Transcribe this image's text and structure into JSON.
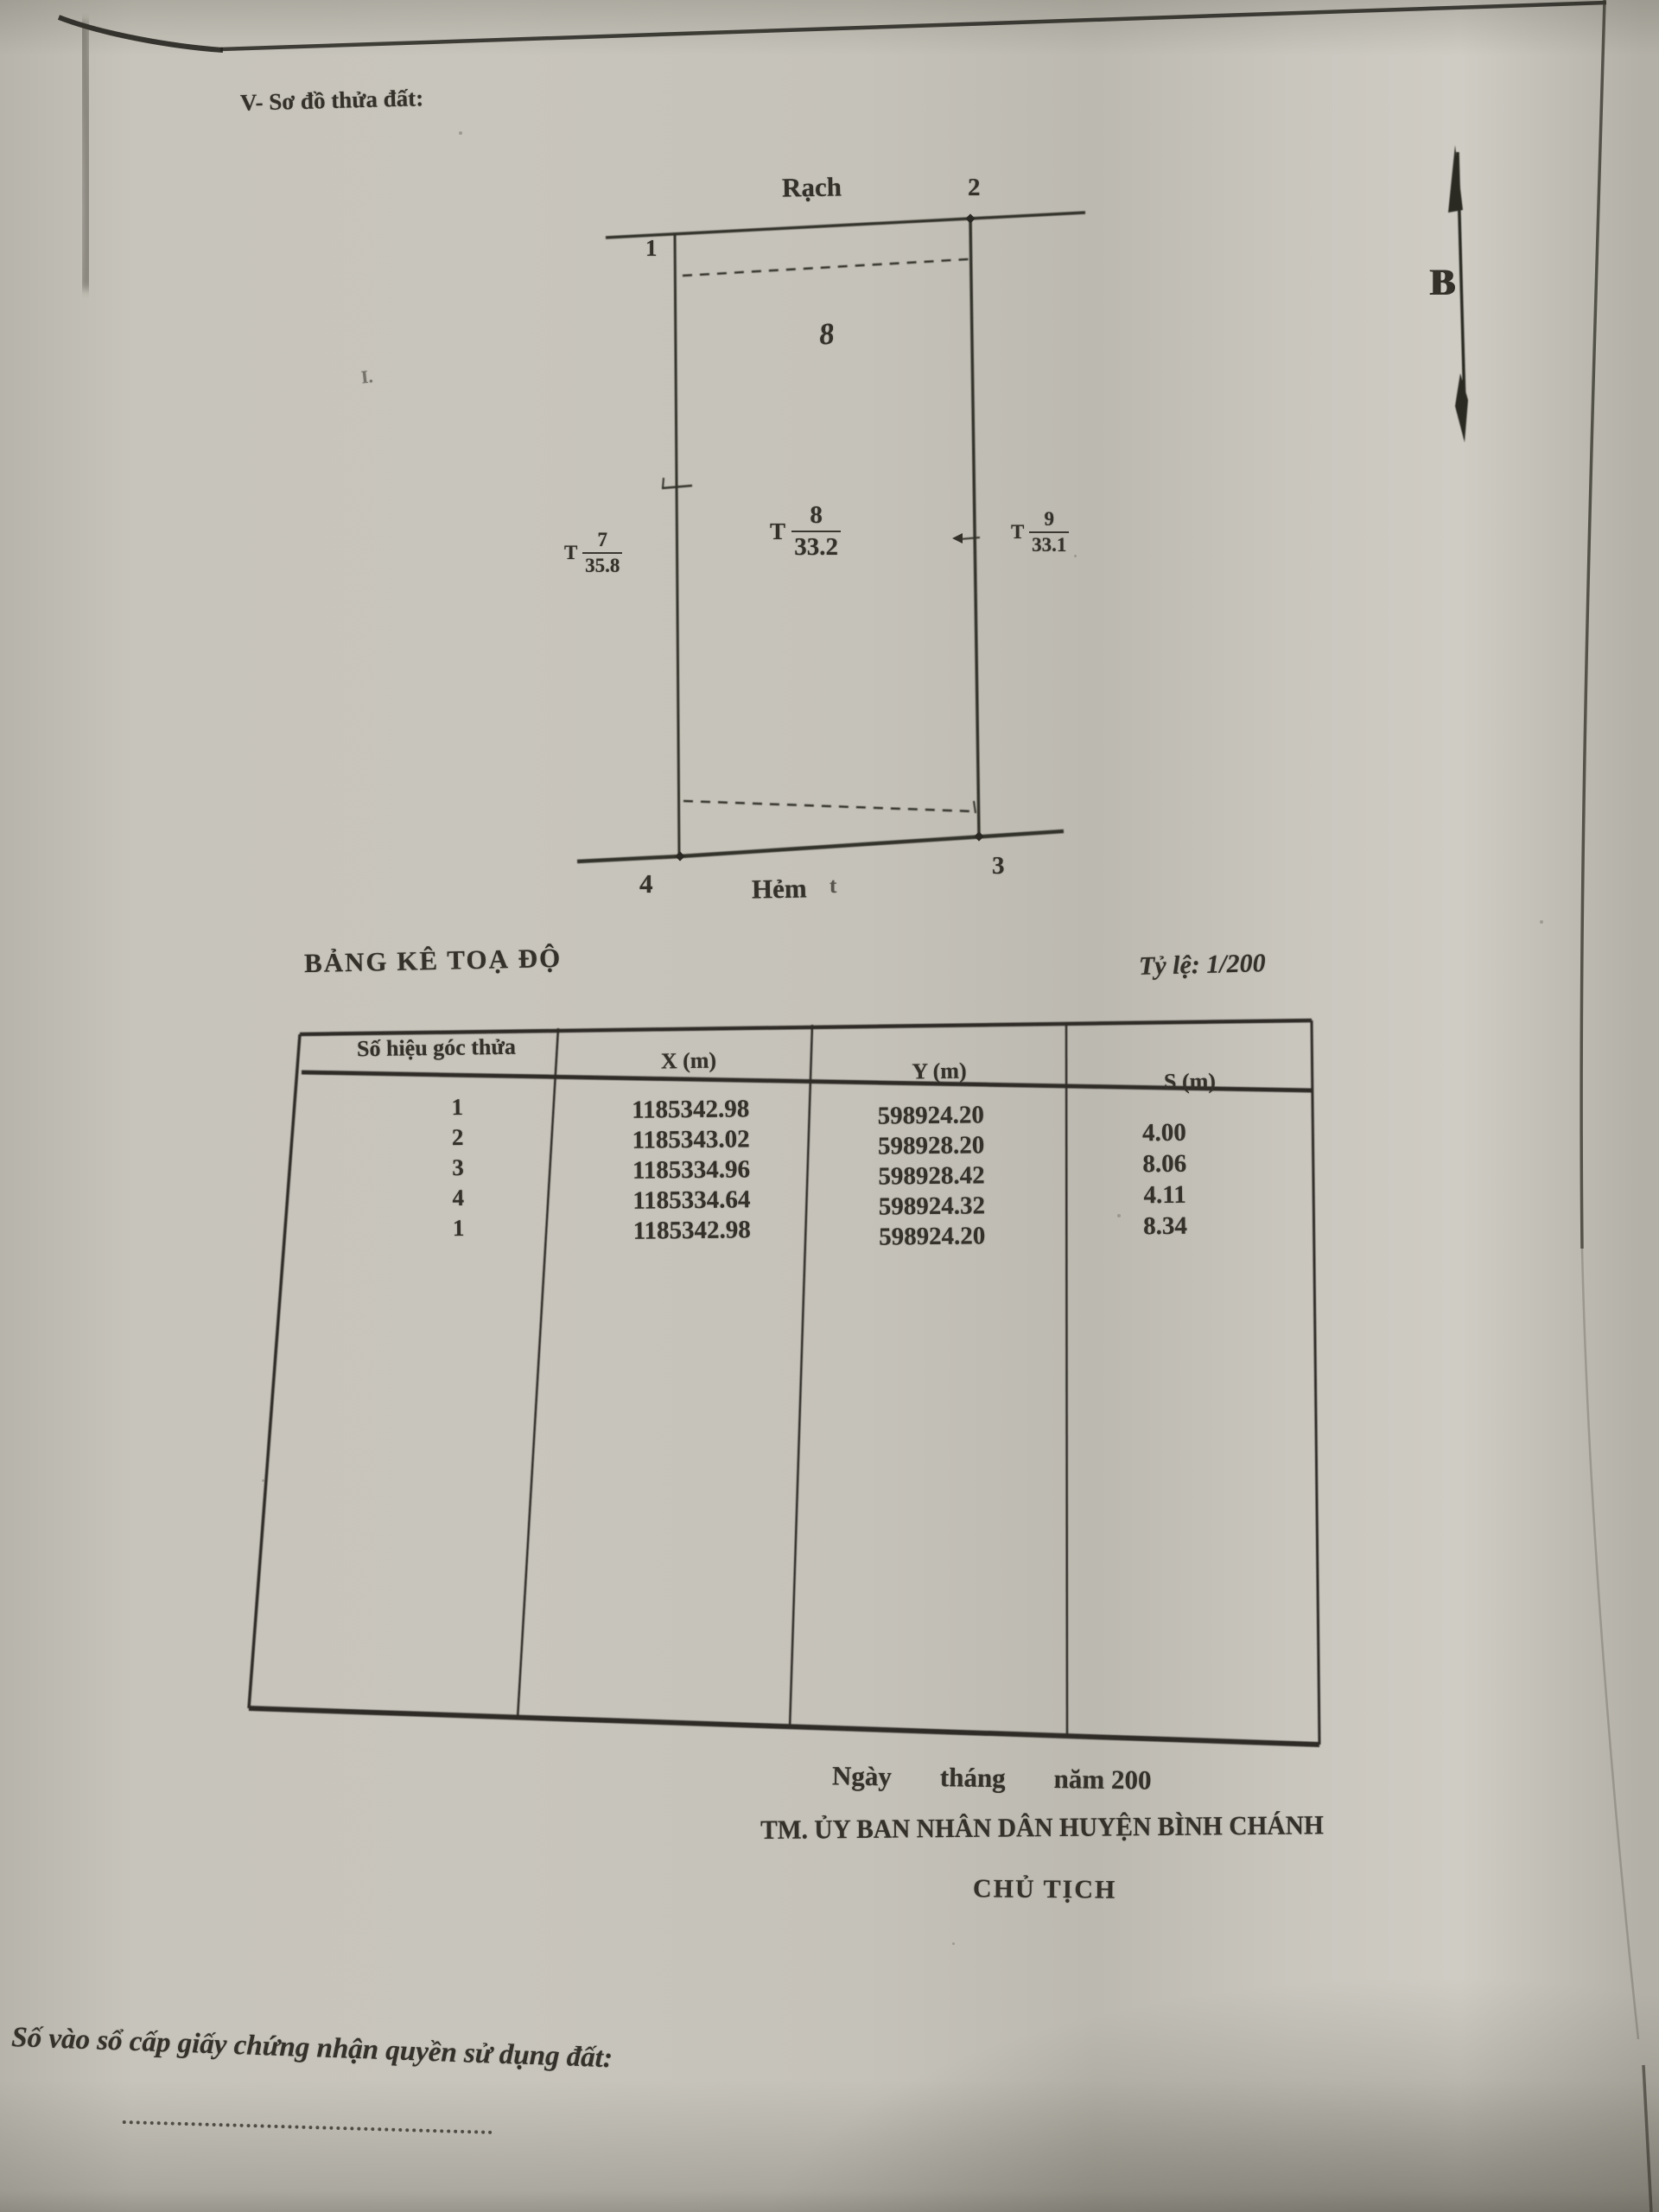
{
  "document": {
    "section_title": "V- Sơ đồ thửa đất:",
    "diagram": {
      "canal_label": "Rạch",
      "alley_label": "Hẻm",
      "corner_1": "1",
      "corner_2": "2",
      "corner_3": "3",
      "corner_4": "4",
      "parcel_number": "8",
      "stray_mark": "t",
      "margin_mark": "I.",
      "north_label": "B",
      "adjacent_left": {
        "prefix": "T",
        "numerator": "7",
        "denominator": "35.8"
      },
      "center_mark": {
        "prefix": "T",
        "numerator": "8",
        "denominator": "33.2"
      },
      "adjacent_right": {
        "prefix": "T",
        "numerator": "9",
        "denominator": "33.1"
      }
    },
    "table": {
      "title": "BẢNG KÊ TOẠ ĐỘ",
      "scale_label": "Tỷ lệ: 1/200",
      "headers": [
        "Số hiệu góc thửa",
        "X (m)",
        "Y (m)",
        "S (m)"
      ],
      "point_ids": [
        "1",
        "2",
        "3",
        "4",
        "1"
      ],
      "x_values": [
        "1185342.98",
        "1185343.02",
        "1185334.96",
        "1185334.64",
        "1185342.98"
      ],
      "y_values": [
        "598924.20",
        "598928.20",
        "598928.42",
        "598924.32",
        "598924.20"
      ],
      "s_values": [
        "4.00",
        "8.06",
        "4.11",
        "8.34"
      ]
    },
    "signature": {
      "date_words": [
        "Ngày",
        "tháng",
        "năm 200"
      ],
      "authority_line": "TM. ỦY BAN NHÂN DÂN HUYỆN BÌNH CHÁNH",
      "signer_title": "CHỦ TỊCH"
    },
    "footer": {
      "register_label": "Số vào sổ cấp giấy chứng nhận quyền sử dụng đất:"
    },
    "colors": {
      "paper": "#c6c3ba",
      "ink": "#33312a"
    }
  }
}
